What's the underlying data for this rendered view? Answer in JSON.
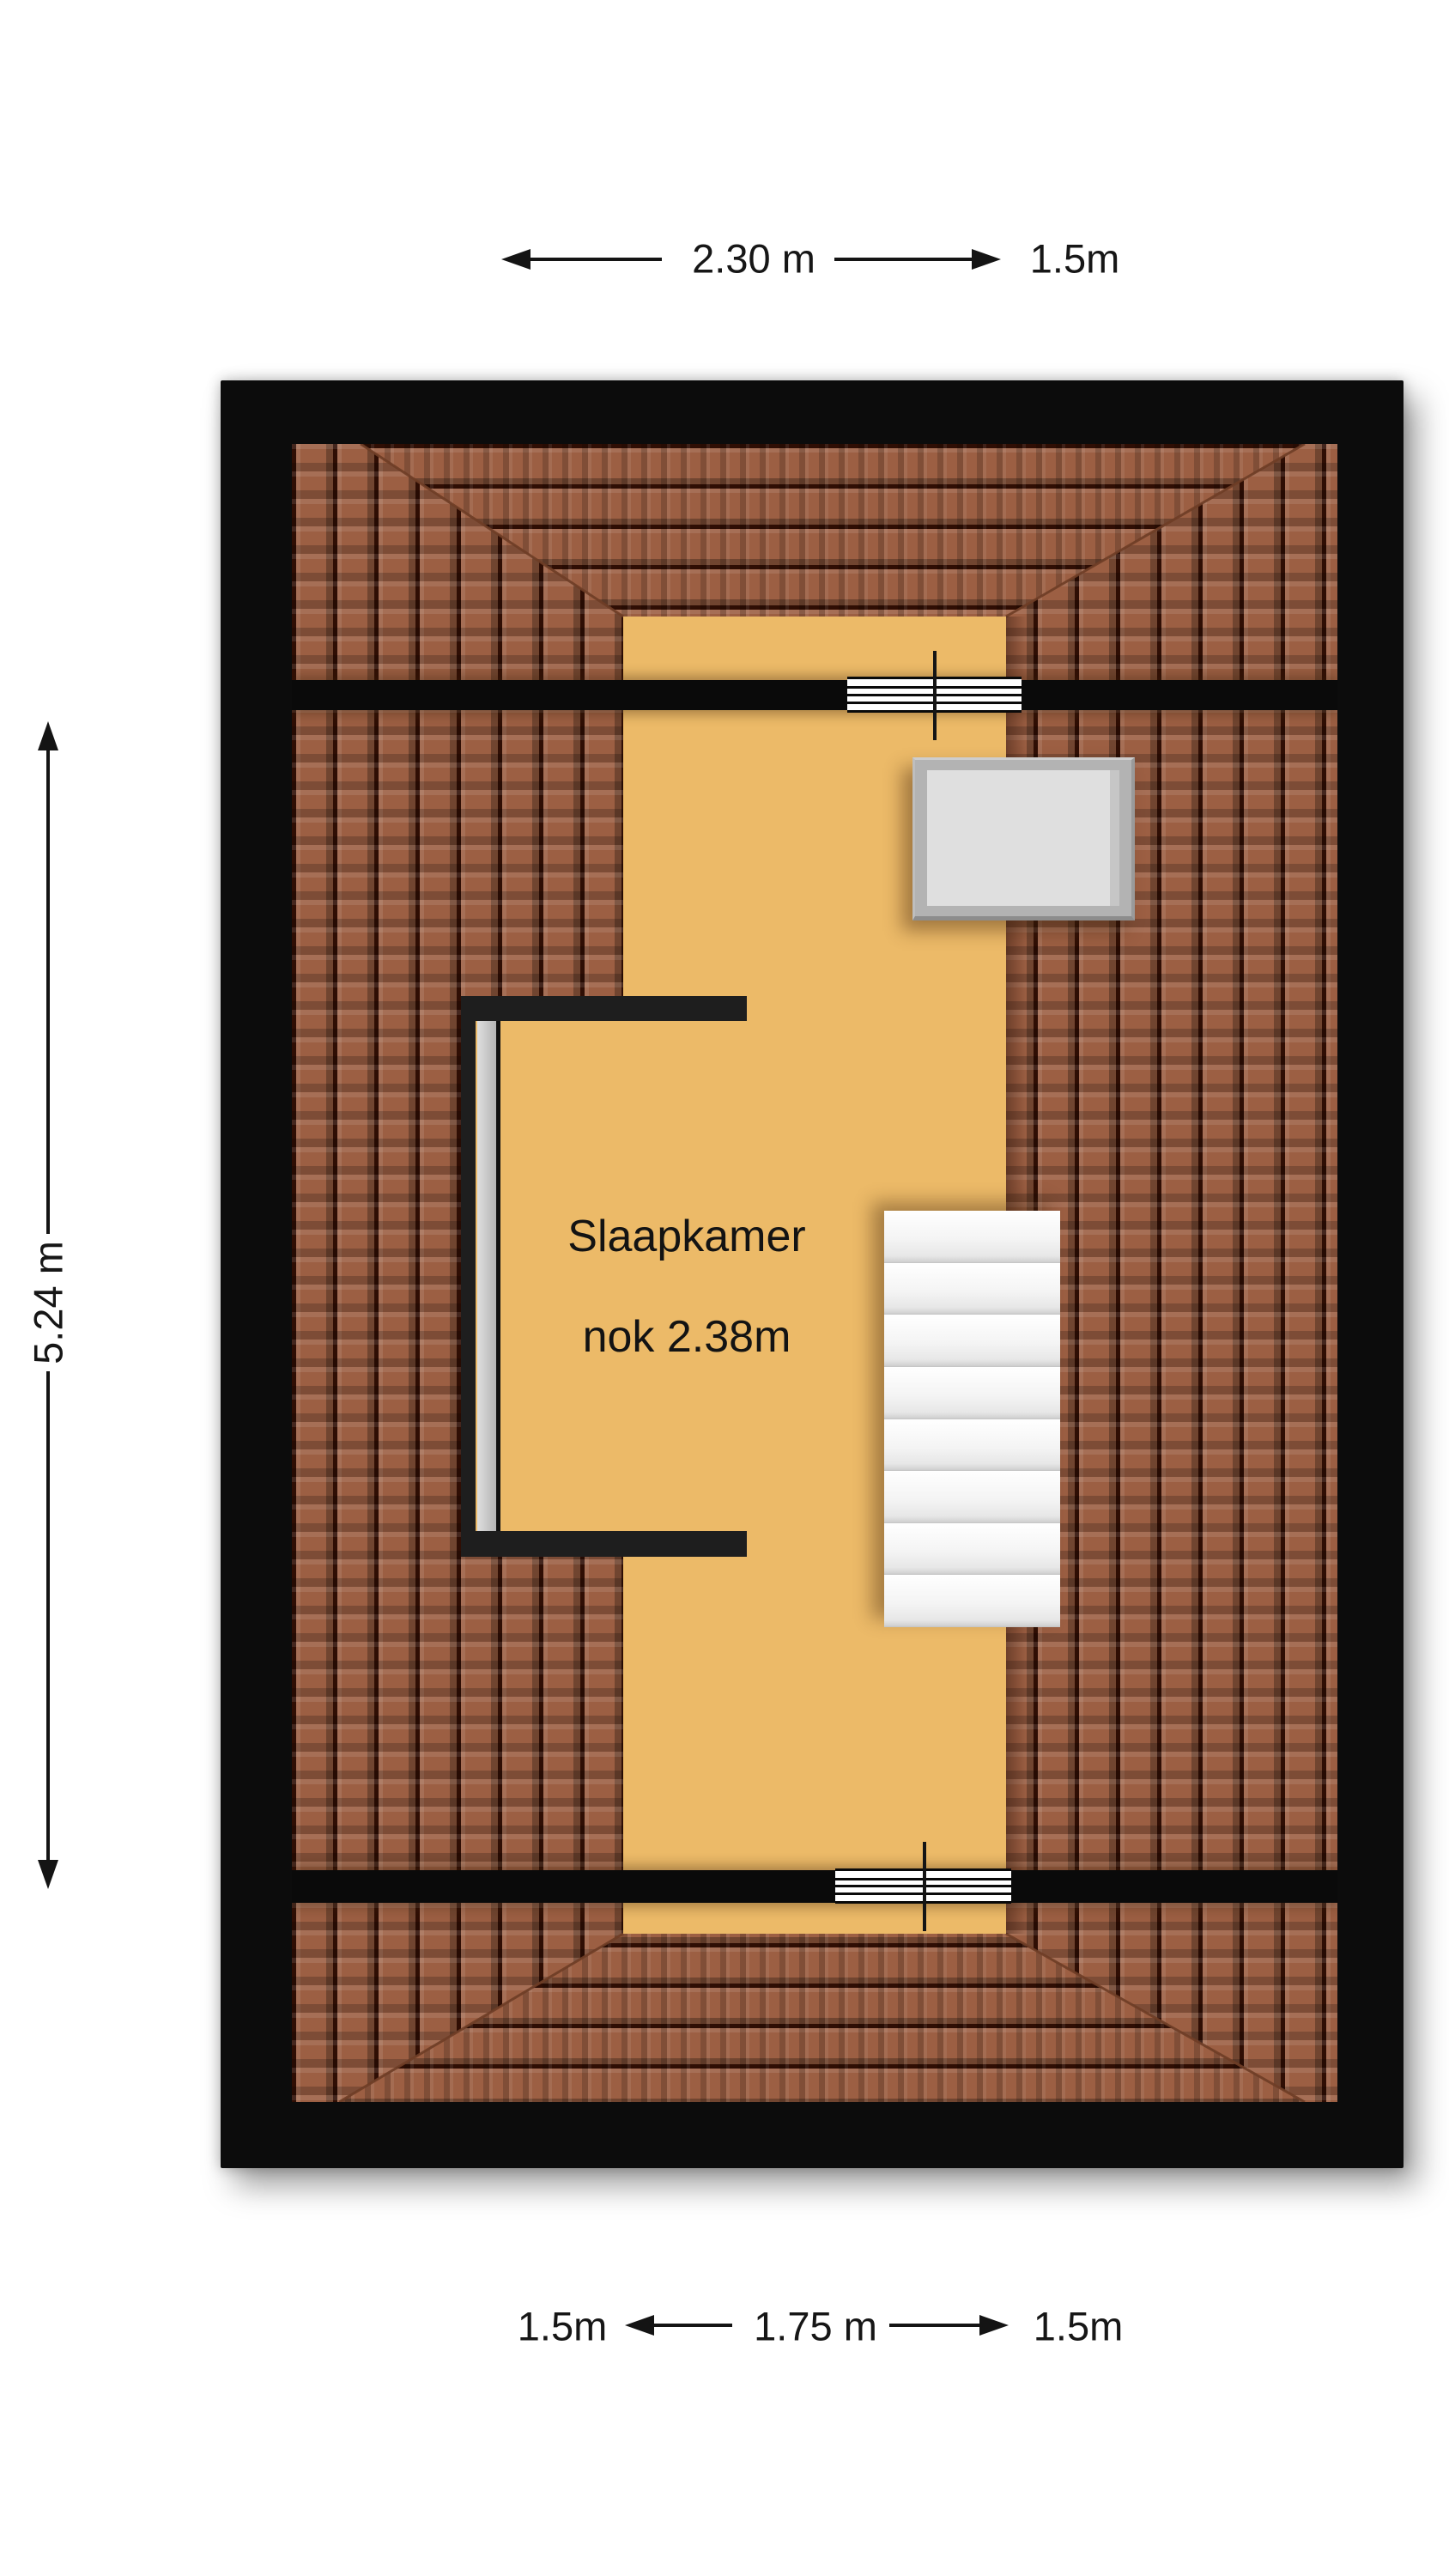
{
  "dimensions": {
    "top": {
      "span": "2.30 m",
      "right": "1.5m"
    },
    "left": {
      "span": "5.24 m"
    },
    "bottom": {
      "left": "1.5m",
      "span": "1.75 m",
      "right": "1.5m"
    }
  },
  "plan": {
    "room": {
      "name": "Slaapkamer",
      "note": "nok 2.38m"
    },
    "stairs": {
      "steps": 8
    }
  },
  "colors": {
    "floor": "#ecba68",
    "tile": "#9c5f43",
    "tile_joint": "#2f0e04",
    "wall": "#0c0c0c",
    "partition": "#1e1e1e",
    "lining": "#c9c9c9",
    "step": "#f2f2f2",
    "skylight_frame": "#b3b3b3",
    "skylight_pane": "#dfdfdf",
    "text": "#111111"
  }
}
